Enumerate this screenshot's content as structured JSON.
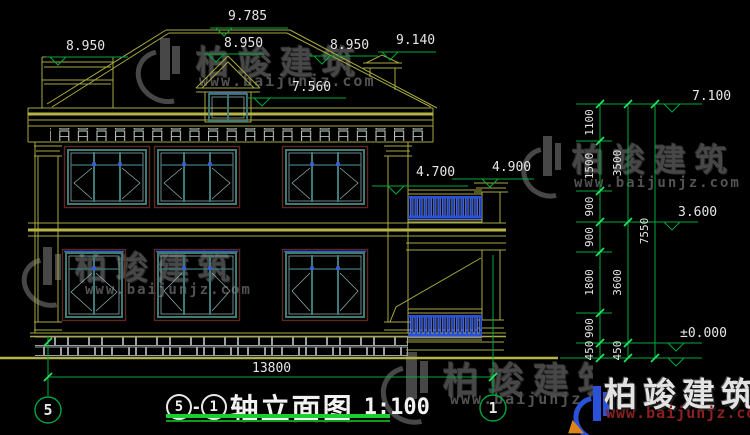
{
  "watermark": {
    "brand": "柏竣建筑",
    "url": "www.baijunjz.com"
  },
  "title_block": {
    "axis_from": "5",
    "separator": "-",
    "axis_to": "1",
    "name": "轴立面图",
    "scale": "1:100"
  },
  "axis_bubbles": {
    "left": "5",
    "right": "1"
  },
  "dimensions": {
    "overall_width": "13800",
    "right_inner": [
      "1100",
      "1500",
      "900",
      "900",
      "1800",
      "900",
      "450"
    ],
    "right_middle": [
      "3500",
      "3600",
      "450"
    ],
    "right_overall": "7550"
  },
  "elevation_marks": {
    "left_parapet": "8.950",
    "ridge": "9.785",
    "dormer_ridge": "8.950",
    "roof_right": "8.950",
    "chimney_top": "9.140",
    "dormer_eave": "7.560",
    "balcony_rail": "4.700",
    "balcony_pillar": "4.900",
    "right_eave": "7.100",
    "second_floor": "3.600",
    "zero_level": "±0.000"
  }
}
